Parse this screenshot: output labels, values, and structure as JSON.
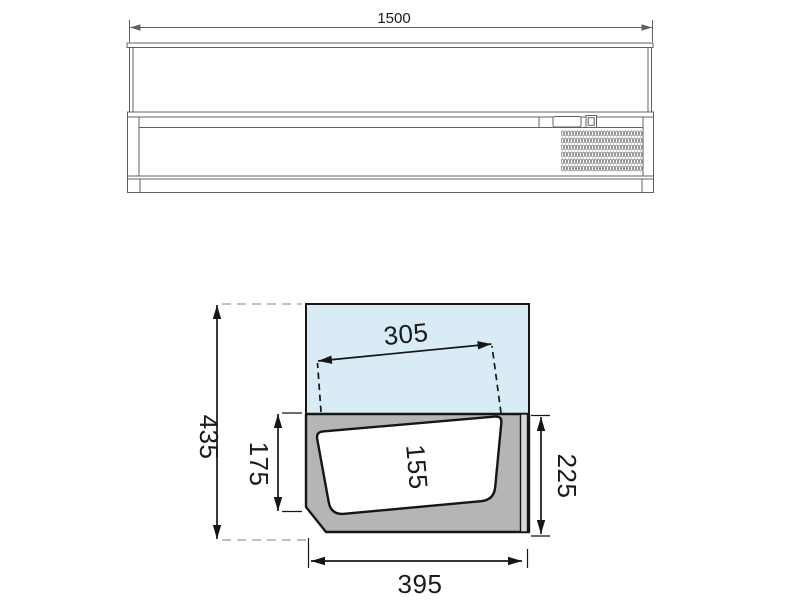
{
  "front_view": {
    "width_dim": "1500"
  },
  "section_view": {
    "total_height_dim": "435",
    "opening_width_dim": "305",
    "pan_depth_dim": "175",
    "pan_inner_height_dim": "155",
    "rear_height_dim": "225",
    "base_depth_dim": "395"
  },
  "colors": {
    "glass_fill": "#d9ecf6",
    "body_fill": "#b5b5b5",
    "strip_fill": "#d8d8d8",
    "pan_fill": "#ffffff",
    "line_dark": "#161616",
    "line_light": "#606060",
    "background": "#ffffff"
  }
}
